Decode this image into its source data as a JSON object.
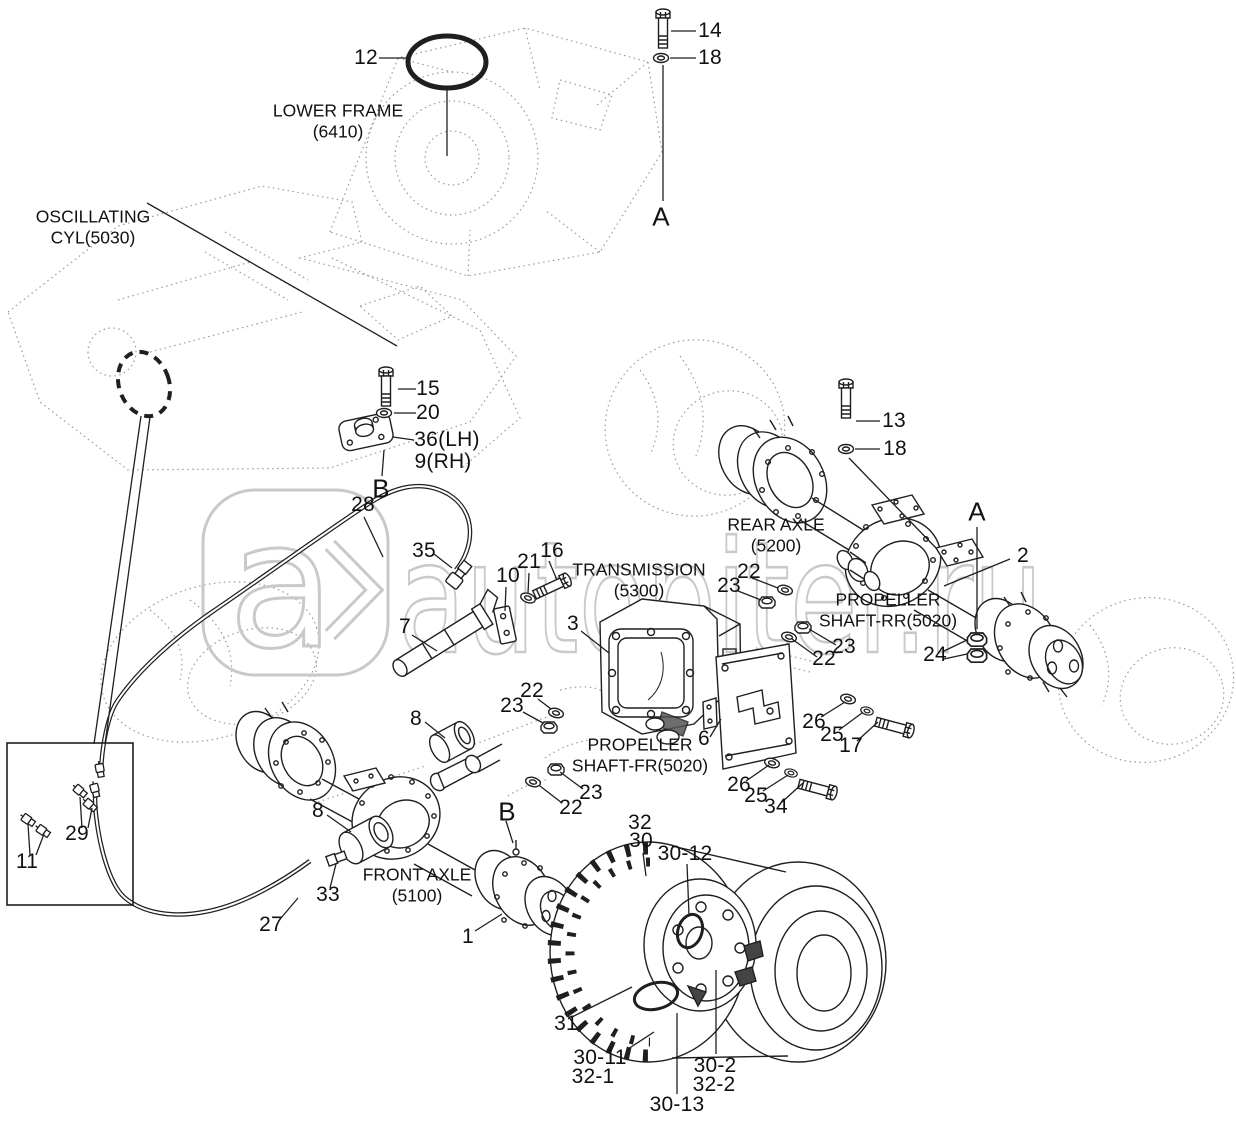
{
  "watermark": {
    "text": "autopiter.ru",
    "logo_letter": "a",
    "color": "#c9c9c9"
  },
  "assembly_labels": {
    "lower_frame": {
      "line1": "LOWER FRAME",
      "line2": "(6410)"
    },
    "oscillating_cyl": {
      "line1": "OSCILLATING",
      "line2": "CYL(5030)"
    },
    "transmission": {
      "line1": "TRANSMISSION",
      "line2": "(5300)"
    },
    "rear_axle": {
      "line1": "REAR AXLE",
      "line2": "(5200)"
    },
    "propeller_shaft_rr": {
      "line1": "PROPELLER",
      "line2": "SHAFT-RR(5020)"
    },
    "propeller_shaft_fr": {
      "line1": "PROPELLER",
      "line2": "SHAFT-FR(5020)"
    },
    "front_axle": {
      "line1": "FRONT AXLE",
      "line2": "(5100)"
    }
  },
  "section_markers": {
    "a_top": "A",
    "a_right": "A",
    "b_upper": "B",
    "b_lower": "B"
  },
  "callouts": {
    "c12": "12",
    "c14": "14",
    "c18_top": "18",
    "c15": "15",
    "c20": "20",
    "c36": "36(LH)",
    "c9": "9(RH)",
    "c28": "28",
    "c35": "35",
    "c10": "10",
    "c21": "21",
    "c16": "16",
    "c3": "3",
    "c7": "7",
    "c8_mid": "8",
    "c22_fr_upper": "22",
    "c23_fr_upper": "23",
    "c23_fr_lower": "23",
    "c22_fr_lower": "22",
    "c13": "13",
    "c18_rear": "18",
    "c22_rear_left": "22",
    "c23_rear_left": "23",
    "c2": "2",
    "c23_rear_lower": "23",
    "c22_rear_lower": "22",
    "c24": "24",
    "c26_upper": "26",
    "c25_upper": "25",
    "c17": "17",
    "c6": "6",
    "c26_lower": "26",
    "c25_lower": "25",
    "c34": "34",
    "c29": "29",
    "c11": "11",
    "c8_low": "8",
    "c33": "33",
    "c27": "27",
    "c1": "1",
    "c32": "32",
    "c30": "30",
    "c30_12": "30-12",
    "c31": "31",
    "c30_11": "30-11",
    "c32_1": "32-1",
    "c30_2": "30-2",
    "c32_2": "32-2",
    "c30_13": "30-13"
  }
}
